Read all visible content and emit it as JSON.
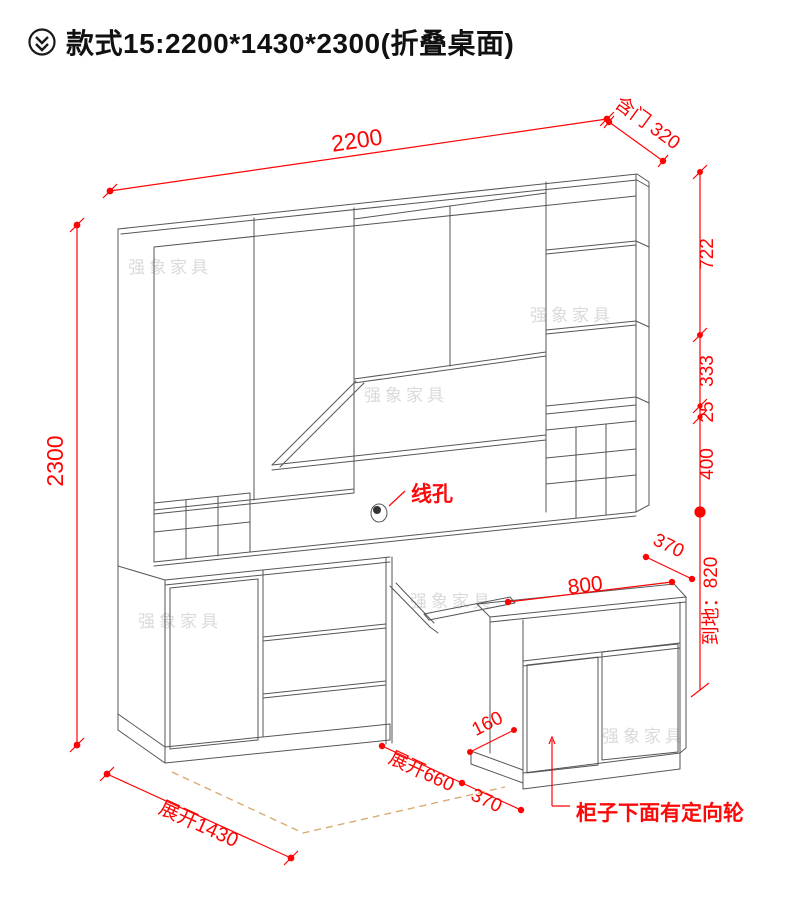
{
  "title": {
    "icon": "circled-double-chevron-down-icon",
    "text": "款式15:2200*1430*2300(折叠桌面)"
  },
  "watermark": {
    "text": "强象家具"
  },
  "colors": {
    "dimension_red": "#fd0404",
    "line_gray": "#55565a",
    "watermark_gray": "#dadada",
    "floor_dash_tan": "#d9ab70",
    "background": "#ffffff"
  },
  "drawing": {
    "annotations": {
      "top_width": "2200",
      "top_right_depth": "含门 320",
      "right_side": {
        "seg1": "722",
        "seg2": "333",
        "seg3": "25",
        "seg4": "400",
        "to_floor": "到地：820"
      },
      "left_height": "2300",
      "wire_hole": "线孔",
      "upper_depth": "370",
      "side_cabinet_width": "800",
      "base_step_depth": "160",
      "unfold_depth": "展开660",
      "unfold_gap": "370",
      "unfold_width": "展开1430",
      "caster_note": "柜子下面有定向轮"
    }
  }
}
